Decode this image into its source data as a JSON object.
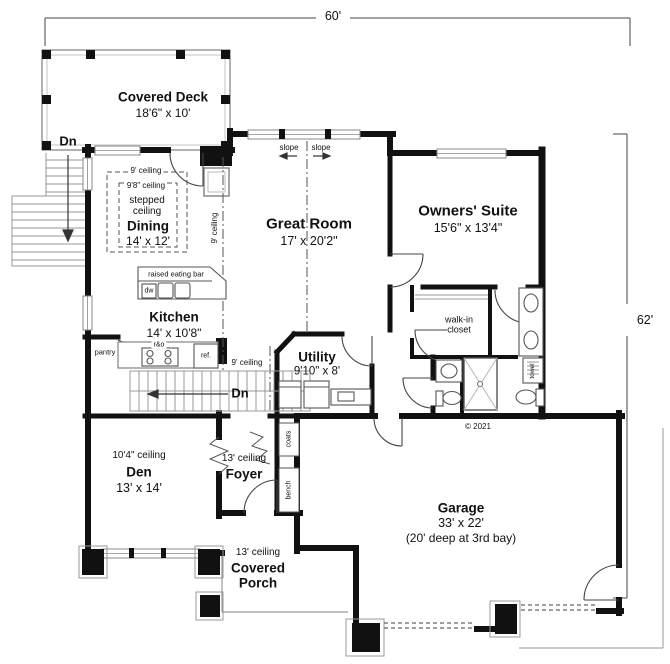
{
  "plan": {
    "dim": {
      "width": "60'",
      "height": "62'"
    },
    "rooms": {
      "covered_deck": {
        "name": "Covered Deck",
        "size": "18'6\" x 10'"
      },
      "dining": {
        "outer_ceiling": "9' ceiling",
        "inner_ceiling": "9'8\" ceiling",
        "stepped_line1": "stepped",
        "stepped_line2": "ceiling",
        "name": "Dining",
        "size": "14' x 12'"
      },
      "great_room": {
        "name": "Great Room",
        "size": "17' x 20'2\""
      },
      "owners_suite": {
        "name": "Owners' Suite",
        "size": "15'6\" x 13'4\""
      },
      "kitchen": {
        "name": "Kitchen",
        "size": "14' x 10'8\""
      },
      "utility": {
        "name": "Utility",
        "size": "9'10\" x 8'"
      },
      "walk_in_closet": {
        "line1": "walk-in",
        "line2": "closet"
      },
      "den": {
        "ceiling": "10'4\" ceiling",
        "name": "Den",
        "size": "13' x 14'"
      },
      "foyer": {
        "ceiling": "13' ceiling",
        "name": "Foyer"
      },
      "covered_porch": {
        "ceiling": "13' ceiling",
        "line1": "Covered",
        "line2": "Porch"
      },
      "garage": {
        "name": "Garage",
        "size": "33' x 22'",
        "note": "(20' deep at 3rd bay)"
      }
    },
    "labels": {
      "dn_deck": "Dn",
      "dn_interior": "Dn",
      "slope_left": "slope",
      "slope_right": "slope",
      "ceiling_break": "9' ceiling",
      "hall_ceiling": "9' ceiling",
      "eating_bar": "raised eating bar",
      "dw": "dw",
      "pantry": "pantry",
      "range": "r&o",
      "fridge": "ref.",
      "coats": "coats",
      "bench": "bench",
      "towel": "towel",
      "copyright": "© 2021"
    }
  }
}
